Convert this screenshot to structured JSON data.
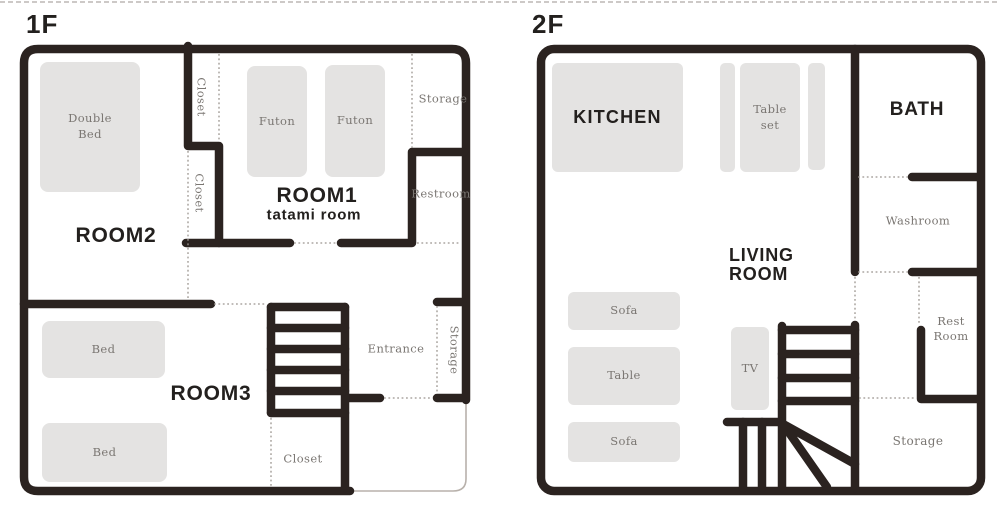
{
  "colors": {
    "wall": "#2b2320",
    "furniture": "#e4e3e2",
    "furniture_label": "#7a7672",
    "room_label": "#23201e",
    "dotted": "#9b958f",
    "thin_outline": "#b8b1ab",
    "background": "#ffffff"
  },
  "floor1": {
    "title": "1F",
    "rooms": {
      "room2": "ROOM2",
      "room1": "ROOM1",
      "room1_subtitle": "tatami room",
      "room3": "ROOM3"
    },
    "areas": {
      "closet_upper": "Closet",
      "closet_middle": "Closet",
      "storage_top": "Storage",
      "restroom": "Restroom",
      "entrance": "Entrance",
      "storage_entrance": "Storage",
      "closet_bottom": "Closet"
    },
    "furniture": {
      "double_bed": "Double Bed",
      "futon_left": "Futon",
      "futon_right": "Futon",
      "bed_upper": "Bed",
      "bed_lower": "Bed"
    }
  },
  "floor2": {
    "title": "2F",
    "rooms": {
      "kitchen": "KITCHEN",
      "bath": "BATH",
      "living_room": "LIVING ROOM"
    },
    "areas": {
      "washroom": "Washroom",
      "rest_room": "Rest Room",
      "storage": "Storage"
    },
    "furniture": {
      "table_set": "Table set",
      "sofa_upper": "Sofa",
      "table": "Table",
      "sofa_lower": "Sofa",
      "tv": "TV"
    }
  }
}
